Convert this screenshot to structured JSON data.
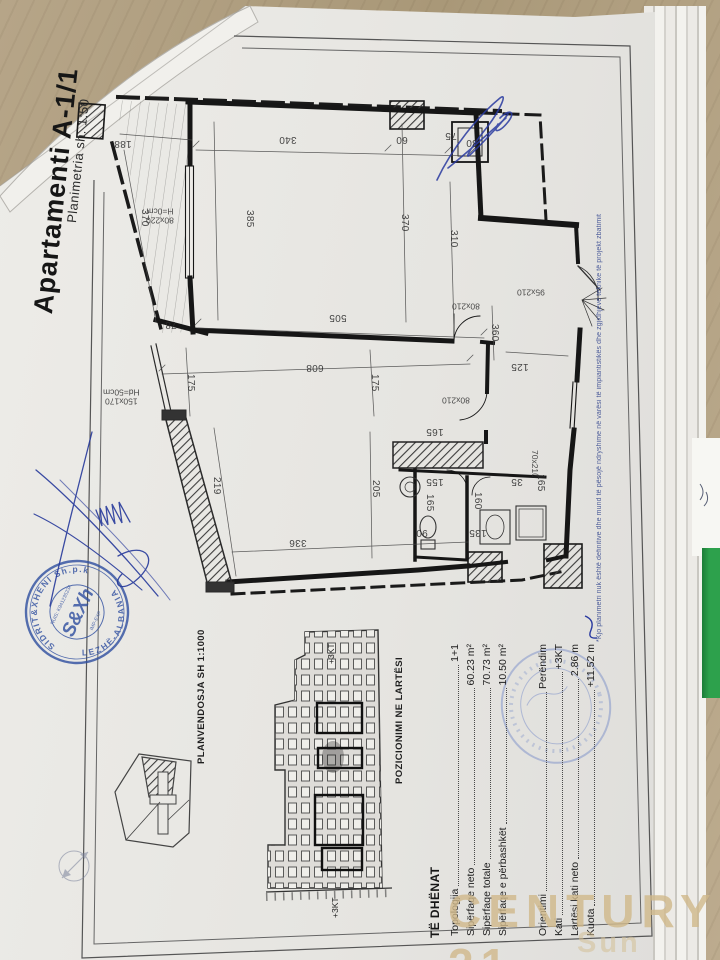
{
  "document": {
    "title": "Apartamenti A-1/1",
    "subtitle": "Planimetria   sh. 1:50",
    "footnote": "*Kjo planimetri nuk është definitive dhe mund të pësojë ndryshime në varësi të impiantistikës dhe zgjidhjeve teknike të projekt zbatimit",
    "site_plan_label": "PLANVENDOSJA SH 1:1000",
    "elevation_label": "POZICIONIMI NE LARTËSI",
    "floor_tag_top": "+3KT",
    "floor_tag_bottom": "+3KT"
  },
  "plan": {
    "dims": {
      "d188": "188",
      "d340": "340",
      "d60": "60",
      "d75": "75",
      "d30": "30",
      "d370_terrace": "370",
      "d385": "385",
      "d370_room": "370",
      "d310": "310",
      "d505": "505",
      "d608": "608",
      "d336": "336",
      "d78": "78",
      "d175_left": "175",
      "d175_right": "175",
      "d219": "219",
      "d205": "205",
      "d125": "125",
      "d360": "360",
      "d160": "160",
      "d155": "155",
      "d165_kitchen": "165",
      "d165_bath": "165",
      "d165_right": "165",
      "d135": "135",
      "d90": "90",
      "d35": "35"
    },
    "openings": {
      "balcony_door": "80x220",
      "balcony_door_h": "H=0cm",
      "window": "150x170",
      "window_h": "Hd=50cm",
      "entry_door": "95x210",
      "hall_door": "80x210",
      "bath_door": "80x210",
      "small_door": "70x210"
    }
  },
  "data_table": {
    "header": "TË DHËNAT",
    "rows": [
      {
        "label": "Topologjia",
        "value": "1+1"
      },
      {
        "label": "Sipërfaqe neto",
        "value": "60.23 m²"
      },
      {
        "label": "Sipërfaqe totale",
        "value": "70.73 m²"
      },
      {
        "label": "Sipërfaqe e përbashkët",
        "value": "10.50 m²"
      },
      {
        "label": "Orientimi",
        "value": "Perëndim"
      },
      {
        "label": "Kati",
        "value": "+3KT"
      },
      {
        "label": "Lartësi kati neto",
        "value": "2.86 m"
      },
      {
        "label": "Kuota",
        "value": "+11.52 m"
      }
    ]
  },
  "stamp": {
    "ring_top": "SIDRIT&XHENI Sh.p.k",
    "ring_bottom": "LEZHË-ALBANIA",
    "center": "S&Xh",
    "nuis": "NUIS: K94123523A",
    "impexp": "IMP-EXP"
  },
  "watermark": {
    "line1": "CENTURY 21",
    "line2": "Sun"
  }
}
